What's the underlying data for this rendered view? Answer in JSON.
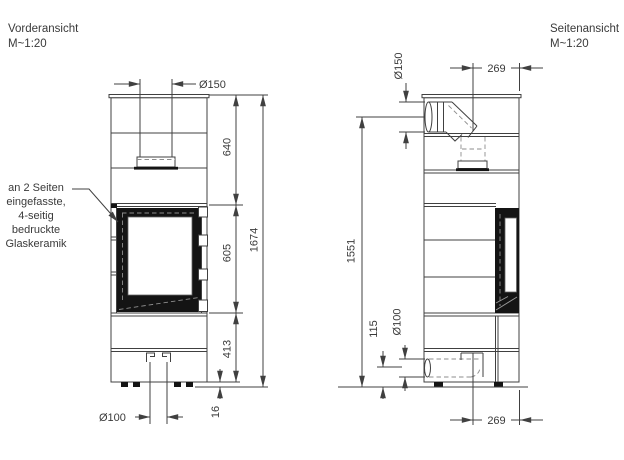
{
  "front_view": {
    "title": "Vorderansicht",
    "scale": "M~1:20",
    "annotation": [
      "an 2 Seiten",
      "eingefasste,",
      "4-seitig",
      "bedruckte",
      "Glaskeramik"
    ],
    "dims": {
      "flue_diameter": "Ø150",
      "height_top_section": "640",
      "height_door_section": "605",
      "height_base_section": "413",
      "height_total": "1674",
      "height_feet": "16",
      "air_intake_diameter": "Ø100"
    }
  },
  "side_view": {
    "title": "Seitenansicht",
    "scale": "M~1:20",
    "dims": {
      "flue_diameter": "Ø150",
      "flue_axis_offset": "269",
      "flue_axis_height": "1551",
      "air_axis_height": "115",
      "air_intake_diameter": "Ø100",
      "air_axis_offset": "269"
    }
  },
  "colors": {
    "line": "#404040",
    "dark_fill": "#141414",
    "background": "#ffffff"
  }
}
